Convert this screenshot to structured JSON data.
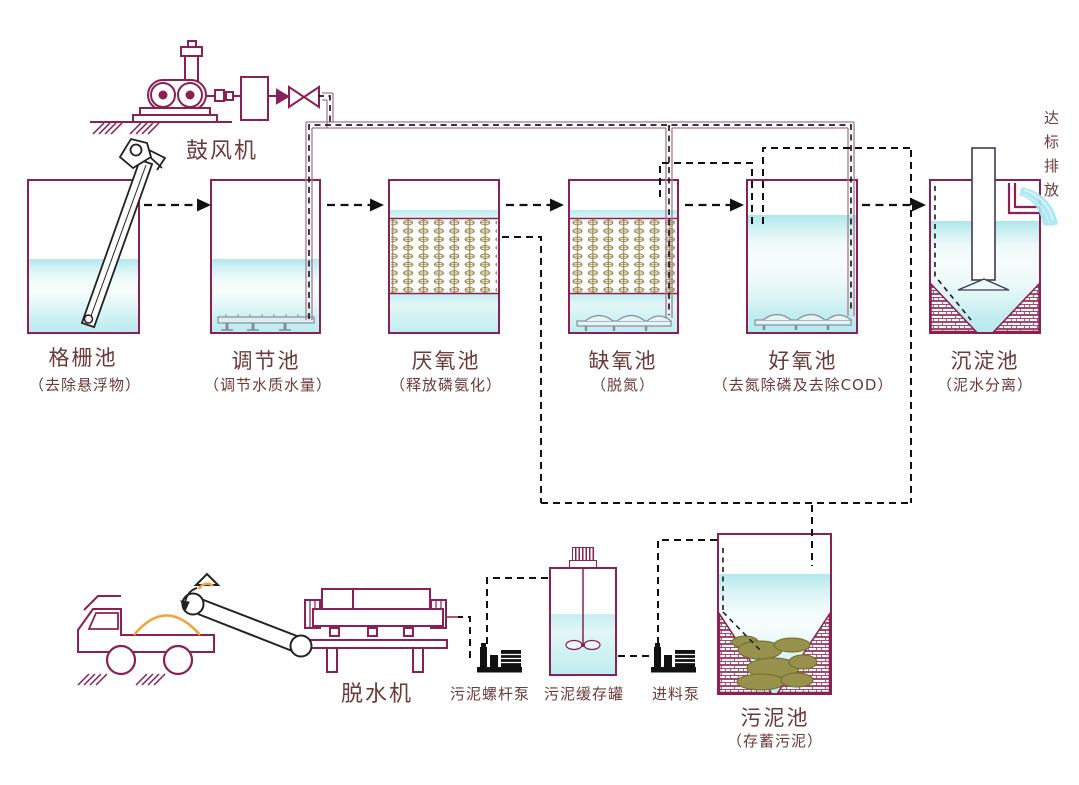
{
  "diagram_title": "污水处理工艺流程图",
  "blower": {
    "label": "鼓风机"
  },
  "discharge": {
    "label": "达标排放"
  },
  "tanks": [
    {
      "name": "格栅池",
      "desc": "（去除悬浮物）"
    },
    {
      "name": "调节池",
      "desc": "（调节水质水量）"
    },
    {
      "name": "厌氧池",
      "desc": "（释放磷氨化）"
    },
    {
      "name": "缺氧池",
      "desc": "（脱氮）"
    },
    {
      "name": "好氧池",
      "desc": "（去氮除磷及去除COD）"
    },
    {
      "name": "沉淀池",
      "desc": "（泥水分离）"
    }
  ],
  "sludge_section": {
    "dewaterer_label": "脱水机",
    "screw_pump_label": "污泥螺杆泵",
    "buffer_tank_label": "污泥缓存罐",
    "feed_pump_label": "进料泵",
    "sludge_tank_name": "污泥池",
    "sludge_tank_desc": "（存蓄污泥）"
  },
  "colors": {
    "tank_outline": "#8b2052",
    "label_text": "#6b3a3a",
    "flow_line": "#1c1c1c",
    "air_pipe": "#a87890",
    "water": "#c9f0f2",
    "media": "#8f7d3c",
    "sludge": "#98914c",
    "aerator": "#7c929e",
    "orange": "#f0a23c"
  }
}
